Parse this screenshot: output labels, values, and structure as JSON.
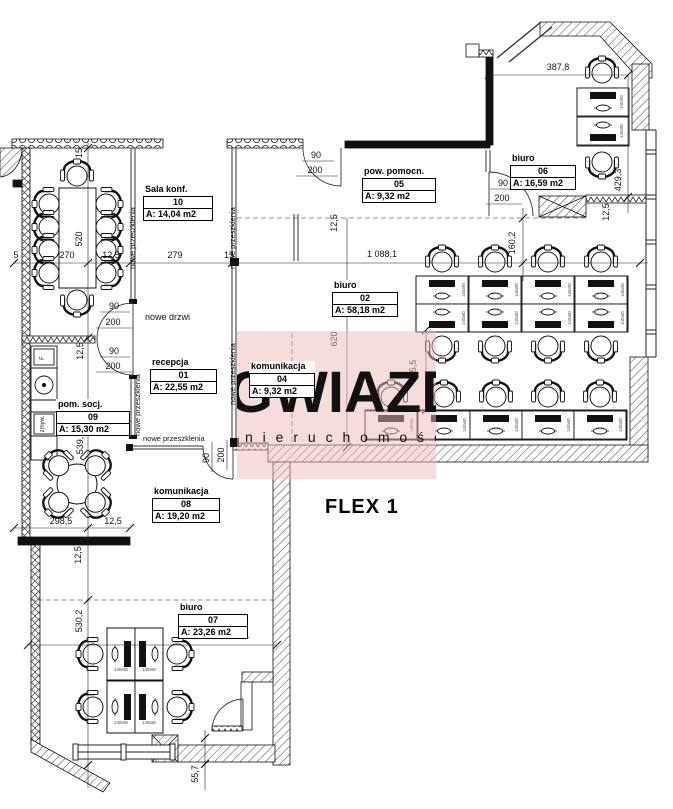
{
  "title": {
    "flex_label": "FLEX 1"
  },
  "watermark": {
    "brand": "GWIAZDA",
    "subtitle": "n i e r u c h o m o ś c i",
    "color": "#efb9b9"
  },
  "rooms": [
    {
      "name": "Sala konf.",
      "number": "10",
      "area": "A: 14,04 m2"
    },
    {
      "name": "pow. pomocn.",
      "number": "05",
      "area": "A: 9,32 m2"
    },
    {
      "name": "biuro",
      "number": "06",
      "area": "A: 16,59 m2"
    },
    {
      "name": "biuro",
      "number": "02",
      "area": "A: 58,18 m2"
    },
    {
      "name": "recepcja",
      "number": "01",
      "area": "A: 22,55 m2"
    },
    {
      "name": "komunikacja",
      "number": "04",
      "area": "A: 9,32 m2"
    },
    {
      "name": "pom. socj.",
      "number": "09",
      "area": "A: 15,30 m2"
    },
    {
      "name": "komunikacja",
      "number": "08",
      "area": "A: 19,20 m2"
    },
    {
      "name": "biuro",
      "number": "07",
      "area": "A: 23,26 m2"
    }
  ],
  "dims": [
    "387,8",
    "429,3",
    "12,5",
    "160,2",
    "1 088,1",
    "5",
    "270",
    "12,5",
    "279",
    "15",
    "15",
    "520",
    "620",
    "205,5",
    "12,5",
    "12,5",
    "539,7",
    "298,5",
    "12,5",
    "12,5",
    "530,2",
    "636,1",
    "55,7"
  ],
  "doors": {
    "w": "90",
    "h": "200"
  },
  "annotations": {
    "new_door": "nowe drzwi",
    "new_glazing": "nowe przeszklenia",
    "dishwasher": "zmyw.",
    "fridge": "F"
  },
  "furniture": {
    "desk_size": "140x80"
  }
}
